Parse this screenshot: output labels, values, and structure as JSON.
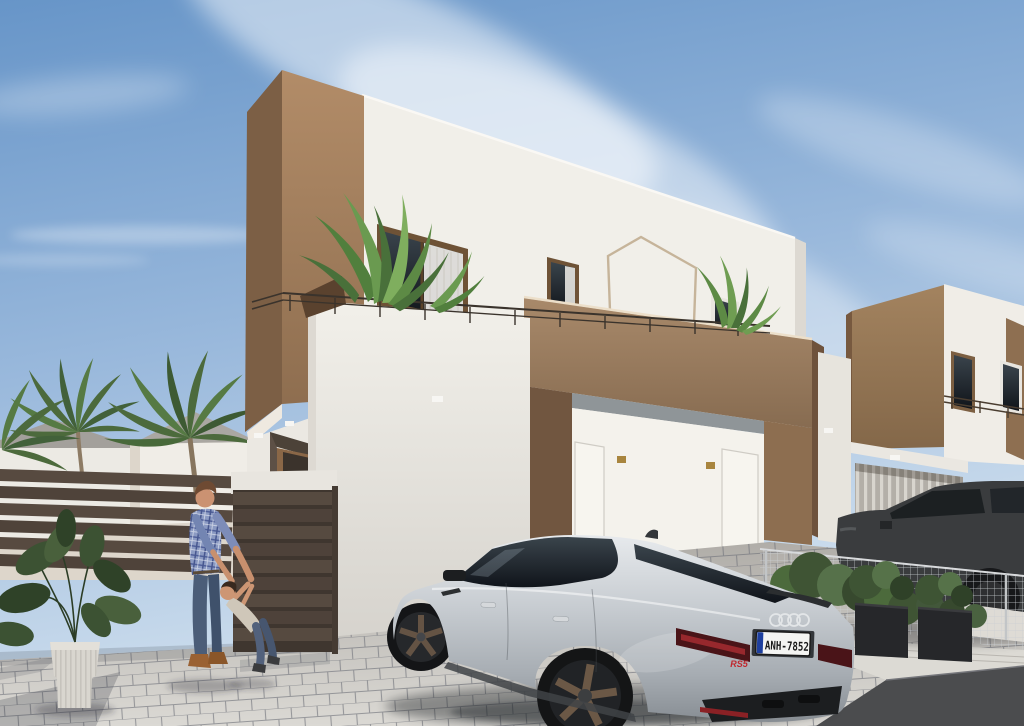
{
  "scene": {
    "description": "Sunny 3D architectural rendering of modern two-storey white and brown villas with a paved driveway, palm trees, a father playing with his child, and a silver Audi RS5 parked outside",
    "sky": "clear blue sky with wispy diagonal clouds"
  },
  "vehicles": {
    "audi": {
      "type": "silver sportback coupe seen from rear three-quarter",
      "license_plate": "ANH-7852",
      "model_badge": "RS5",
      "emblem": "four overlapping rings"
    },
    "suv": {
      "type": "dark grey SUV parked behind the wire fence on the right"
    }
  },
  "people": {
    "father": "man in blue plaid shirt, jeans and tan boots leaning toward child",
    "child": "toddler in light top and jeans being held by the man's hands"
  },
  "buildings": {
    "main_villa": "two-storey white villa with brown corner column, roof terrace with railing, pentagon wall decor and recessed double entry",
    "neighbor_villa": "matching villa on the right with slatted garage door",
    "background": "low white houses with grey hip roofs behind the left fence"
  },
  "landscaping": {
    "palms": "palm trees behind the left slatted fence",
    "terrace_plants": "tropical strelitzia leaves on the roof terrace",
    "potted_plant": "large leafy plant in a ribbed grey pot at bottom left",
    "hedge": "green shrubs and two dark planter boxes along the wire fence"
  },
  "colors": {
    "sky_top": "#6795c8",
    "sky_mid": "#9ab9dc",
    "sky_horizon": "#cfdfee",
    "wall_white": "#f1efe9",
    "brown_light": "#b28c68",
    "brown_dark": "#7c5f45",
    "parapet_brown": "#a8896a",
    "car_silver_high": "#e7eaed",
    "car_silver_low": "#878d93",
    "paving": "#dbd9d4",
    "fence_brown": "#574a40",
    "foliage_green": "#4c6a3c"
  }
}
